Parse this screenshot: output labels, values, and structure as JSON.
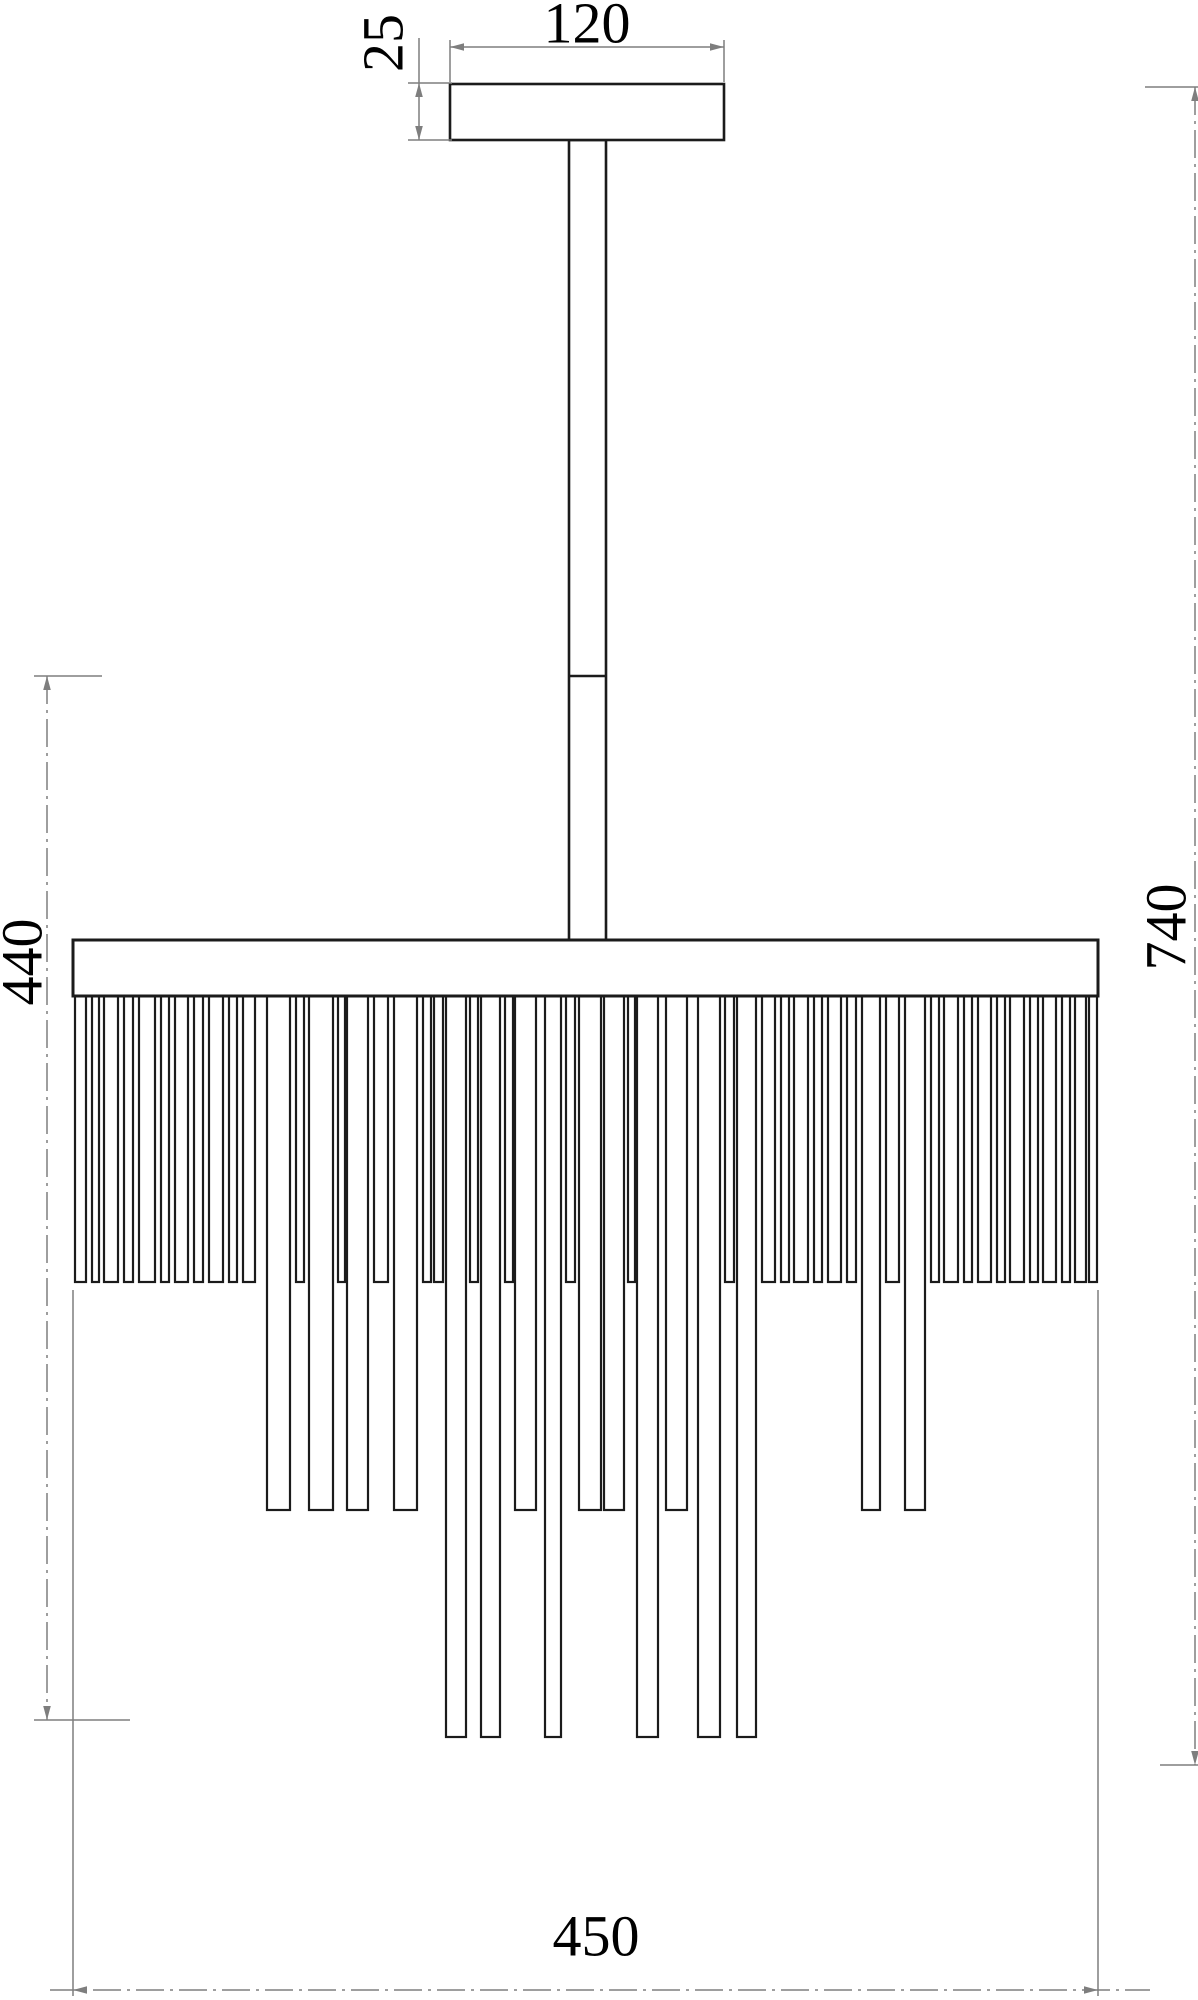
{
  "drawing": {
    "title": "chandelier-technical-dimension-drawing",
    "units": "mm",
    "canvas": {
      "w": 1198,
      "h": 2000
    },
    "colors": {
      "part_line": "#1b1b1b",
      "dim_line": "#7e7e7e",
      "dim_text": "#000000",
      "background": "#ffffff"
    },
    "line_widths": {
      "part": 2.6,
      "crystal": 2.2,
      "dim": 1.5
    },
    "parts": {
      "canopy": {
        "x": 450,
        "y": 84,
        "w": 274,
        "h": 56
      },
      "rod": {
        "x": 569,
        "y": 140,
        "w": 37,
        "h": 800,
        "joint_y": 676
      },
      "plate": {
        "x": 73,
        "y": 940,
        "w": 1025,
        "h": 56
      },
      "fringe": {
        "top": 996,
        "tier_bottoms": {
          "t1": 1282,
          "t2": 1510,
          "t3": 1737
        },
        "rods": [
          [
            75,
            11,
            1
          ],
          [
            92,
            7,
            1
          ],
          [
            104,
            14,
            1
          ],
          [
            124,
            9,
            1
          ],
          [
            139,
            16,
            1
          ],
          [
            161,
            8,
            1
          ],
          [
            175,
            13,
            1
          ],
          [
            194,
            9,
            1
          ],
          [
            209,
            14,
            1
          ],
          [
            229,
            8,
            1
          ],
          [
            243,
            12,
            1
          ],
          [
            267,
            23,
            2
          ],
          [
            296,
            8,
            1
          ],
          [
            309,
            24,
            2
          ],
          [
            338,
            7,
            1
          ],
          [
            347,
            21,
            2
          ],
          [
            374,
            14,
            1
          ],
          [
            394,
            23,
            2
          ],
          [
            423,
            8,
            1
          ],
          [
            434,
            9,
            1
          ],
          [
            446,
            20,
            3
          ],
          [
            470,
            8,
            1
          ],
          [
            481,
            19,
            3
          ],
          [
            505,
            8,
            1
          ],
          [
            515,
            21,
            2
          ],
          [
            545,
            16,
            3
          ],
          [
            566,
            9,
            1
          ],
          [
            579,
            22,
            2
          ],
          [
            604,
            20,
            2
          ],
          [
            628,
            7,
            1
          ],
          [
            637,
            21,
            3
          ],
          [
            666,
            21,
            2
          ],
          [
            698,
            22,
            3
          ],
          [
            725,
            9,
            1
          ],
          [
            737,
            19,
            3
          ],
          [
            762,
            13,
            1
          ],
          [
            781,
            8,
            1
          ],
          [
            794,
            14,
            1
          ],
          [
            814,
            8,
            1
          ],
          [
            828,
            13,
            1
          ],
          [
            847,
            9,
            1
          ],
          [
            862,
            18,
            2
          ],
          [
            886,
            13,
            1
          ],
          [
            905,
            20,
            2
          ],
          [
            931,
            8,
            1
          ],
          [
            944,
            14,
            1
          ],
          [
            964,
            8,
            1
          ],
          [
            978,
            13,
            1
          ],
          [
            997,
            8,
            1
          ],
          [
            1010,
            14,
            1
          ],
          [
            1030,
            8,
            1
          ],
          [
            1043,
            13,
            1
          ],
          [
            1062,
            8,
            1
          ],
          [
            1075,
            11,
            1
          ],
          [
            1089,
            8,
            1
          ]
        ]
      }
    },
    "font_size": 58,
    "dash_pattern": "28 6 3 6",
    "dimensions": [
      {
        "id": "dim-120",
        "label": "120",
        "rotated": false,
        "text": {
          "x": 587,
          "y": 23
        },
        "lines": [
          {
            "x1": 450,
            "y1": 47,
            "x2": 724,
            "y2": 47,
            "dash": false
          }
        ],
        "exts": [
          {
            "x1": 450,
            "y1": 40,
            "x2": 450,
            "y2": 82
          },
          {
            "x1": 724,
            "y1": 40,
            "x2": 724,
            "y2": 82
          }
        ],
        "arrows": [
          {
            "x": 450,
            "y": 47,
            "dir": "left"
          },
          {
            "x": 724,
            "y": 47,
            "dir": "right"
          }
        ]
      },
      {
        "id": "dim-25",
        "label": "25",
        "rotated": true,
        "text": {
          "x": 383,
          "y": 43
        },
        "lines": [
          {
            "x1": 419,
            "y1": 38,
            "x2": 419,
            "y2": 140,
            "dash": false
          }
        ],
        "exts": [
          {
            "x1": 408,
            "y1": 83,
            "x2": 452,
            "y2": 83
          },
          {
            "x1": 408,
            "y1": 140,
            "x2": 452,
            "y2": 140
          }
        ],
        "arrows": [
          {
            "x": 419,
            "y": 83,
            "dir": "up"
          },
          {
            "x": 419,
            "y": 140,
            "dir": "down"
          }
        ]
      },
      {
        "id": "dim-740",
        "label": "740",
        "rotated": true,
        "text": {
          "x": 1166,
          "y": 927
        },
        "lines": [
          {
            "x1": 1195,
            "y1": 87,
            "x2": 1195,
            "y2": 1765,
            "dash": true
          }
        ],
        "exts": [
          {
            "x1": 1145,
            "y1": 87,
            "x2": 1198,
            "y2": 87
          },
          {
            "x1": 1160,
            "y1": 1765,
            "x2": 1198,
            "y2": 1765
          }
        ],
        "arrows": [
          {
            "x": 1195,
            "y": 87,
            "dir": "up"
          },
          {
            "x": 1195,
            "y": 1765,
            "dir": "down"
          }
        ]
      },
      {
        "id": "dim-440",
        "label": "440",
        "rotated": true,
        "text": {
          "x": 22,
          "y": 962
        },
        "lines": [
          {
            "x1": 47,
            "y1": 676,
            "x2": 47,
            "y2": 1720,
            "dash": true
          }
        ],
        "exts": [
          {
            "x1": 34,
            "y1": 676,
            "x2": 102,
            "y2": 676
          },
          {
            "x1": 34,
            "y1": 1720,
            "x2": 130,
            "y2": 1720
          }
        ],
        "arrows": [
          {
            "x": 47,
            "y": 676,
            "dir": "up"
          },
          {
            "x": 47,
            "y": 1720,
            "dir": "down"
          }
        ]
      },
      {
        "id": "dim-450",
        "label": "450",
        "rotated": false,
        "text": {
          "x": 596,
          "y": 1936
        },
        "lines": [
          {
            "x1": 50,
            "y1": 1990,
            "x2": 1150,
            "y2": 1990,
            "dash": true
          }
        ],
        "exts": [
          {
            "x1": 73,
            "y1": 1290,
            "x2": 73,
            "y2": 1996
          },
          {
            "x1": 1098,
            "y1": 1290,
            "x2": 1098,
            "y2": 1996
          }
        ],
        "arrows": [
          {
            "x": 73,
            "y": 1990,
            "dir": "left"
          },
          {
            "x": 1098,
            "y": 1990,
            "dir": "right"
          }
        ]
      }
    ]
  }
}
